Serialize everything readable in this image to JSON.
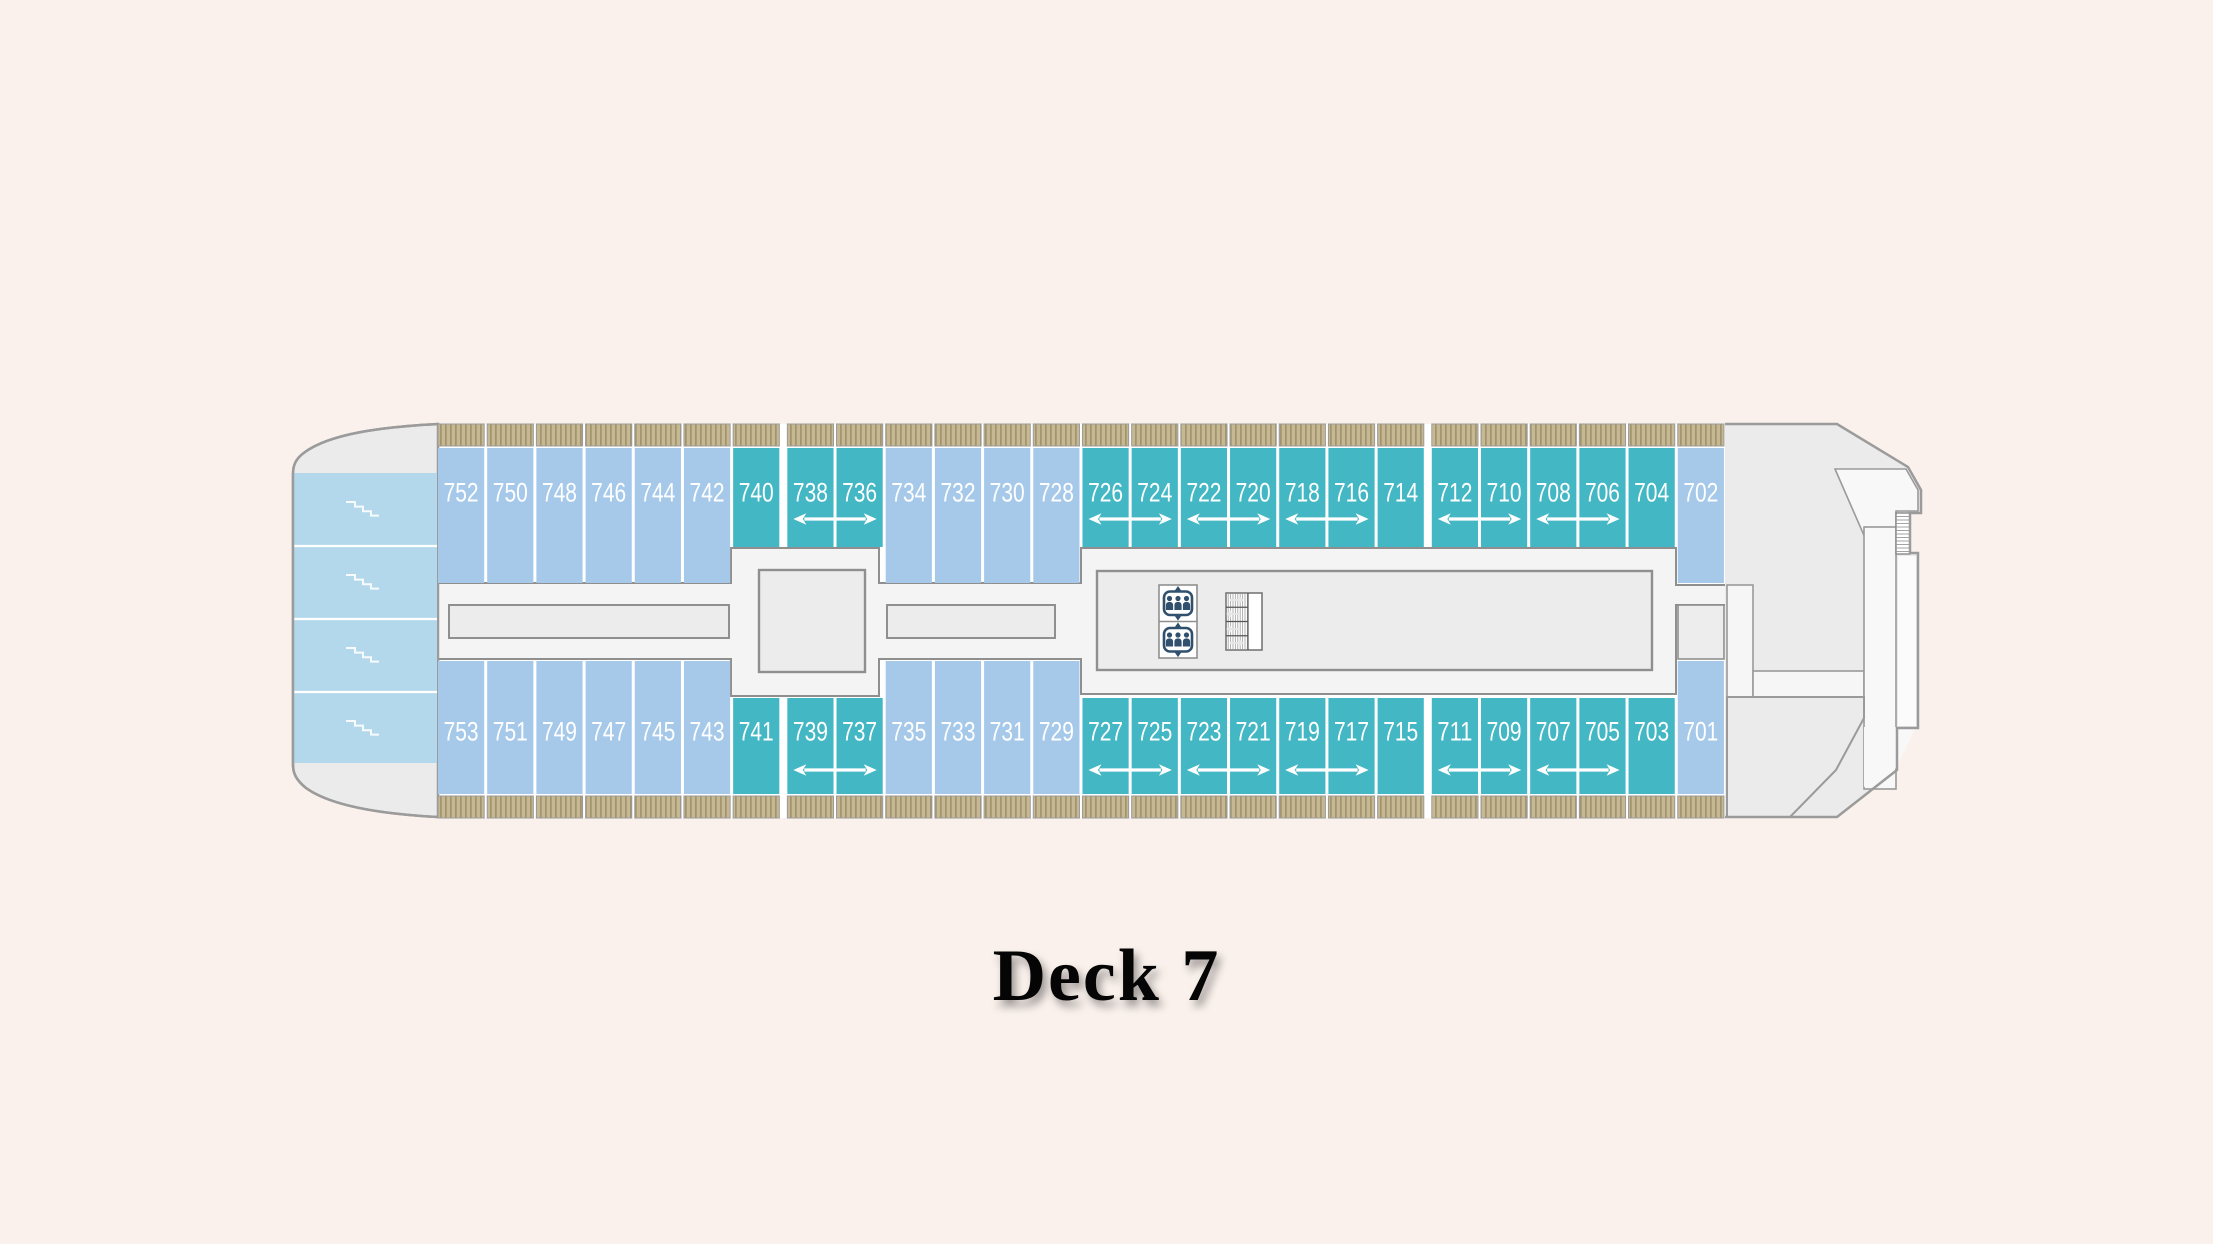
{
  "title": "Deck 7",
  "deck_plan": {
    "rows": {
      "top": {
        "cabins": [
          {
            "number": "752",
            "category": "blue"
          },
          {
            "number": "750",
            "category": "blue"
          },
          {
            "number": "748",
            "category": "blue"
          },
          {
            "number": "746",
            "category": "blue"
          },
          {
            "number": "744",
            "category": "blue"
          },
          {
            "number": "742",
            "category": "blue"
          },
          {
            "number": "740",
            "category": "teal"
          },
          {
            "number": "738",
            "category": "teal"
          },
          {
            "number": "736",
            "category": "teal"
          },
          {
            "number": "734",
            "category": "blue"
          },
          {
            "number": "732",
            "category": "blue"
          },
          {
            "number": "730",
            "category": "blue"
          },
          {
            "number": "728",
            "category": "blue"
          },
          {
            "number": "726",
            "category": "teal"
          },
          {
            "number": "724",
            "category": "teal"
          },
          {
            "number": "722",
            "category": "teal"
          },
          {
            "number": "720",
            "category": "teal"
          },
          {
            "number": "718",
            "category": "teal"
          },
          {
            "number": "716",
            "category": "teal"
          },
          {
            "number": "714",
            "category": "teal"
          },
          {
            "number": "712",
            "category": "teal"
          },
          {
            "number": "710",
            "category": "teal"
          },
          {
            "number": "708",
            "category": "teal"
          },
          {
            "number": "706",
            "category": "teal"
          },
          {
            "number": "704",
            "category": "teal"
          },
          {
            "number": "702",
            "category": "blue"
          }
        ]
      },
      "bottom": {
        "cabins": [
          {
            "number": "753",
            "category": "blue"
          },
          {
            "number": "751",
            "category": "blue"
          },
          {
            "number": "749",
            "category": "blue"
          },
          {
            "number": "747",
            "category": "blue"
          },
          {
            "number": "745",
            "category": "blue"
          },
          {
            "number": "743",
            "category": "blue"
          },
          {
            "number": "741",
            "category": "teal"
          },
          {
            "number": "739",
            "category": "teal"
          },
          {
            "number": "737",
            "category": "teal"
          },
          {
            "number": "735",
            "category": "blue"
          },
          {
            "number": "733",
            "category": "blue"
          },
          {
            "number": "731",
            "category": "blue"
          },
          {
            "number": "729",
            "category": "blue"
          },
          {
            "number": "727",
            "category": "teal"
          },
          {
            "number": "725",
            "category": "teal"
          },
          {
            "number": "723",
            "category": "teal"
          },
          {
            "number": "721",
            "category": "teal"
          },
          {
            "number": "719",
            "category": "teal"
          },
          {
            "number": "717",
            "category": "teal"
          },
          {
            "number": "715",
            "category": "teal"
          },
          {
            "number": "711",
            "category": "teal"
          },
          {
            "number": "709",
            "category": "teal"
          },
          {
            "number": "707",
            "category": "teal"
          },
          {
            "number": "705",
            "category": "teal"
          },
          {
            "number": "703",
            "category": "teal"
          },
          {
            "number": "701",
            "category": "blue"
          }
        ]
      }
    },
    "connecting_room_pairs": {
      "top": [
        [
          "738",
          "736"
        ],
        [
          "726",
          "724"
        ],
        [
          "722",
          "720"
        ],
        [
          "718",
          "716"
        ],
        [
          "712",
          "710"
        ],
        [
          "708",
          "706"
        ]
      ],
      "bottom": [
        [
          "739",
          "737"
        ],
        [
          "727",
          "725"
        ],
        [
          "723",
          "721"
        ],
        [
          "719",
          "717"
        ],
        [
          "711",
          "709"
        ],
        [
          "707",
          "705"
        ]
      ]
    },
    "colors": {
      "cabin_teal": "#43b7c4",
      "cabin_blue": "#a6c9ea",
      "stern_cabin_blue": "#b4d8eb",
      "balcony_tan": "#c6b893",
      "balcony_stripe": "#a2946e",
      "hull_gray": "#ececec",
      "corridor_gray": "#f4f4f4",
      "outline_gray": "#8f8f8f",
      "background": "#faf1ec",
      "icon_navy": "#31506e"
    },
    "icons": [
      "elevator-icon",
      "stairs-icon",
      "stern-stairs-icon",
      "connecting-arrow-icon"
    ]
  }
}
